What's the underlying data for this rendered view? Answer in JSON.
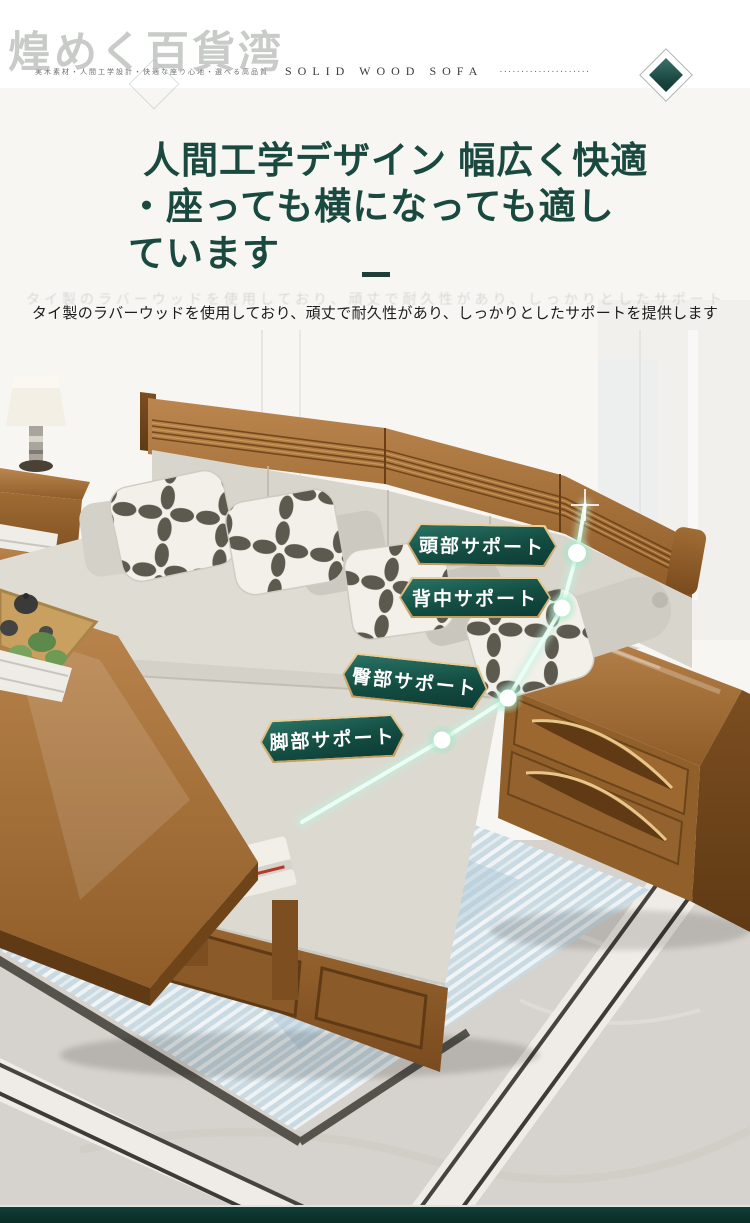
{
  "watermark": {
    "text": "煌めく百貨湾"
  },
  "header": {
    "small_text": "実木素材・人間工学設計・快適な座り心地・選べる高品質",
    "en_text": "SOLID WOOD SOFA",
    "dots": "·····················"
  },
  "hero": {
    "title_line1": "人間工学デザイン 幅広く快適",
    "title_line2": "・座っても横になっても適し",
    "title_line3": "ています",
    "subtitle": "タイ製のラバーウッドを使用しており、頑丈で耐久性があり、しっかりとしたサポートを提供します"
  },
  "callouts": [
    {
      "label": "頭部サポート"
    },
    {
      "label": "背中サポート"
    },
    {
      "label": "臀部サポート"
    },
    {
      "label": "脚部サポート"
    }
  ],
  "colors": {
    "title_green": "#1a4a3f",
    "badge_teal": "#144d42",
    "badge_gold": "#d9b97c",
    "glow_green": "#bff2de",
    "footer_teal": "#0c2f2a",
    "wood_brown": "#9a6832"
  }
}
